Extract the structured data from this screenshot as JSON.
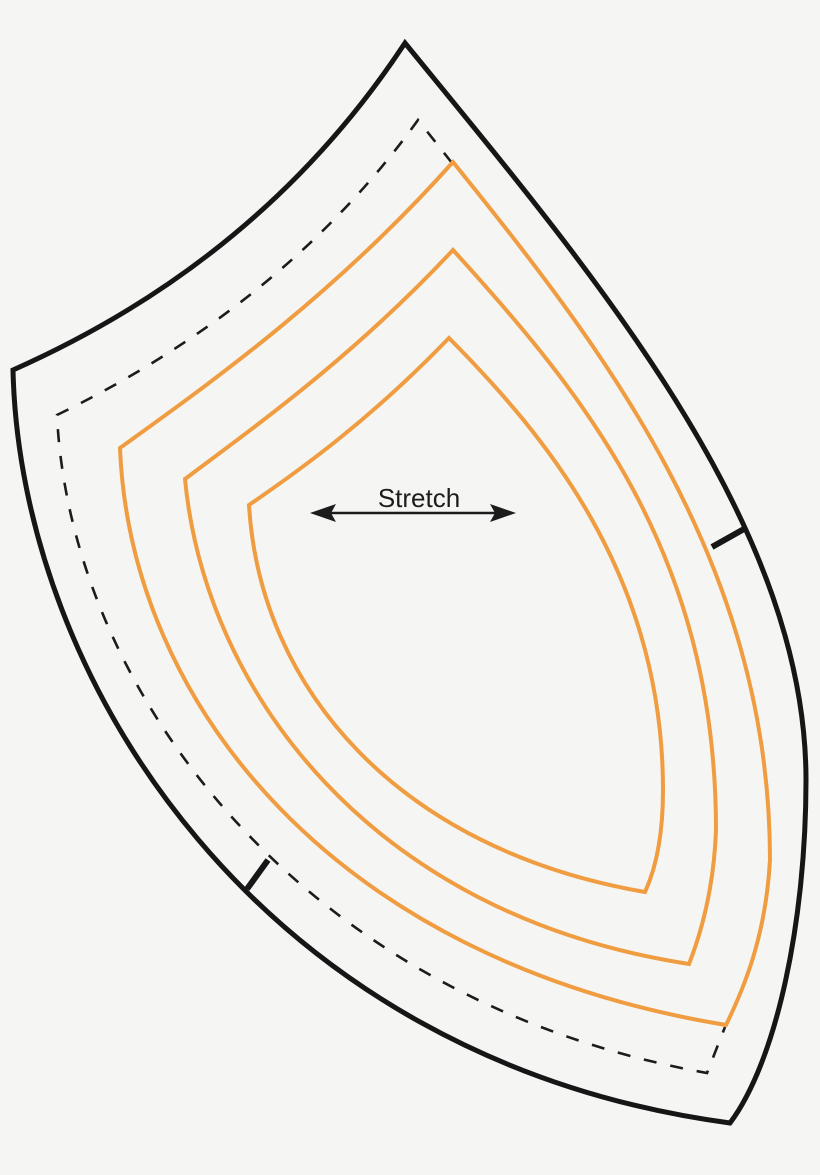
{
  "pattern": {
    "stretch_label": "Stretch"
  },
  "colors": {
    "background": "#f5f5f4",
    "outline_black": "#161616",
    "dash_black": "#1c1c1c",
    "grade_orange": "#f09c40"
  }
}
